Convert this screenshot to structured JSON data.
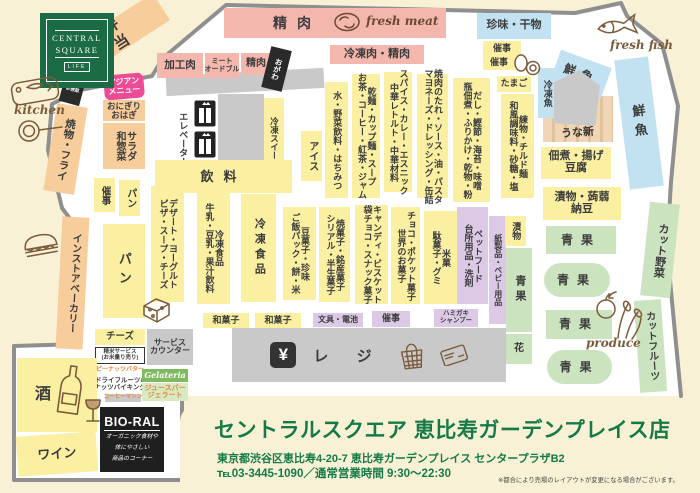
{
  "page": {
    "background": "#F8F1D6",
    "floor": "#FFFFFF",
    "boundary": "#8F8F8F"
  },
  "palette": {
    "deli": "#F6CD9B",
    "meat": "#F4B7AE",
    "fish": "#C2E2F1",
    "groc": "#FBF0A1",
    "nonf": "#DCC9E6",
    "prod": "#CBE3BF",
    "gray": "#C9C9C9",
    "black": "#2A2A2A",
    "pink": "#EC4B95",
    "plain": "transparent",
    "wchip": "#FFFFFF",
    "gchip": "#7FB960",
    "gchip2": "#D8EAC2",
    "accent_green": "#157A47",
    "hand_brown": "#7B5B3A"
  },
  "logo": {
    "line1": "CENTRAL",
    "line2": "SQUARE",
    "line3": "LIFE"
  },
  "annotations": {
    "kitchen": "kitchen",
    "fresh_meat": "fresh meat",
    "fresh_fish": "fresh fish",
    "produce": "produce",
    "unagi_counter": "うな新"
  },
  "checkout": {
    "yen_symbol": "¥",
    "register_label": "レ ジ"
  },
  "bioral": {
    "name": "BIO-RAL",
    "desc_line1": "オーガニック食材や",
    "desc_line2": "体にやさしい",
    "desc_line3": "商品のコーナー"
  },
  "footer": {
    "store_name": "セントラルスクエア 恵比寿ガーデンプレイス店",
    "address": "東京都渋谷区恵比寿4-20-7 恵比寿ガーデンプレイス センタープラザB2",
    "tel_hours": "℡03-3445-1090／通常営業時間 9:30～22:30",
    "note": "※都合により売場のレイアウトが変更になる場合がございます。"
  },
  "areas": [
    {
      "n": "counter-top-gray",
      "t": "gray",
      "x": 166,
      "y": 72,
      "w": 158,
      "h": 20,
      "r": -3,
      "d": "h",
      "fs": 9,
      "lines": []
    },
    {
      "n": "elevator-shaft",
      "t": "gray",
      "x": 218,
      "y": 94,
      "w": 46,
      "h": 68,
      "d": "h",
      "fs": 9,
      "lines": []
    },
    {
      "n": "bento",
      "t": "deli",
      "x": 62,
      "y": 20,
      "w": 108,
      "h": 32,
      "r": -33,
      "d": "v",
      "fs": 15,
      "ls": 4,
      "lines": [
        "弁当"
      ]
    },
    {
      "n": "meat-band",
      "t": "meat",
      "x": 224,
      "y": 8,
      "w": 222,
      "h": 30,
      "d": "h",
      "fs": 10,
      "lines": []
    },
    {
      "n": "meat-band-label",
      "t": "plain",
      "x": 258,
      "y": 12,
      "w": 78,
      "h": 22,
      "d": "h",
      "fs": 14,
      "ls": 10,
      "lines": [
        "精肉"
      ]
    },
    {
      "n": "processed-meat",
      "t": "meat",
      "x": 157,
      "y": 53,
      "w": 46,
      "h": 25,
      "d": "h",
      "fs": 10.5,
      "lines": [
        "加工肉"
      ]
    },
    {
      "n": "meat-hors-doeuvre",
      "t": "meat",
      "x": 205,
      "y": 53,
      "w": 34,
      "h": 25,
      "d": "h",
      "fs": 7,
      "lines": [
        "ミート",
        "オードブル"
      ]
    },
    {
      "n": "fresh-meat-small",
      "t": "meat",
      "x": 241,
      "y": 53,
      "w": 30,
      "h": 22,
      "d": "h",
      "fs": 10,
      "lines": [
        "精肉"
      ]
    },
    {
      "n": "ogawa-shop",
      "t": "black",
      "x": 266,
      "y": 48,
      "w": 21,
      "h": 42,
      "r": 14,
      "d": "v",
      "fs": 7.5,
      "c": "#fff",
      "lines": [
        "おがわ"
      ]
    },
    {
      "n": "frozen-meat",
      "t": "meat",
      "x": 330,
      "y": 45,
      "w": 94,
      "h": 19,
      "d": "h",
      "fs": 11,
      "lines": [
        "冷凍肉・精肉"
      ]
    },
    {
      "n": "delicacies-dried-fish",
      "t": "fish",
      "x": 477,
      "y": 13,
      "w": 74,
      "h": 26,
      "d": "h",
      "fs": 11,
      "lines": [
        "珍味・干物"
      ]
    },
    {
      "n": "event-space-a",
      "t": "groc",
      "x": 483,
      "y": 41,
      "w": 38,
      "h": 15,
      "d": "h",
      "fs": 9,
      "lines": [
        "催事"
      ]
    },
    {
      "n": "event-space-b",
      "t": "groc",
      "x": 483,
      "y": 56,
      "w": 32,
      "h": 14,
      "d": "h",
      "fs": 9,
      "lines": [
        "催事"
      ]
    },
    {
      "n": "eggs-shelf",
      "t": "groc",
      "x": 497,
      "y": 76,
      "w": 34,
      "h": 16,
      "d": "h",
      "fs": 9,
      "lines": [
        "たまご"
      ]
    },
    {
      "n": "frozen-fish",
      "t": "fish",
      "x": 538,
      "y": 68,
      "w": 18,
      "h": 50,
      "d": "v",
      "fs": 9,
      "lines": [
        "冷凍魚"
      ]
    },
    {
      "n": "fresh-fish-corner",
      "t": "fish",
      "x": 554,
      "y": 58,
      "w": 54,
      "h": 32,
      "r": 20,
      "d": "h",
      "fs": 12,
      "ls": 6,
      "lines": [
        "鮮魚"
      ]
    },
    {
      "n": "fish-counter",
      "t": "gray",
      "cls": "pent",
      "x": 554,
      "y": 70,
      "w": 46,
      "h": 56,
      "d": "h",
      "fs": 9,
      "lines": []
    },
    {
      "n": "fresh-fish-band",
      "t": "fish",
      "x": 622,
      "y": 58,
      "w": 34,
      "h": 130,
      "r": -7,
      "d": "v",
      "fs": 13,
      "ls": 6,
      "lines": [
        "鮮魚"
      ]
    },
    {
      "n": "tsukudani-fried-tofu",
      "t": "groc",
      "x": 541,
      "y": 147,
      "w": 70,
      "h": 32,
      "d": "h",
      "fs": 11,
      "lines": [
        "佃煮・揚げ",
        "豆腐"
      ]
    },
    {
      "n": "pickles-konnyaku-natto",
      "t": "groc",
      "x": 543,
      "y": 187,
      "w": 78,
      "h": 33,
      "d": "h",
      "fs": 11,
      "lines": [
        "漬物・蒟蒻",
        "納豆"
      ]
    },
    {
      "n": "produce-1",
      "t": "prod",
      "x": 546,
      "y": 226,
      "w": 70,
      "h": 28,
      "d": "h",
      "fs": 12,
      "ls": 8,
      "lines": [
        "青果"
      ]
    },
    {
      "n": "produce-2",
      "t": "prod",
      "x": 544,
      "y": 263,
      "w": 66,
      "h": 34,
      "br": 17,
      "d": "h",
      "fs": 12,
      "ls": 8,
      "lines": [
        "青果"
      ]
    },
    {
      "n": "produce-3",
      "t": "prod",
      "x": 546,
      "y": 310,
      "w": 66,
      "h": 29,
      "d": "h",
      "fs": 12,
      "ls": 8,
      "lines": [
        "青果"
      ]
    },
    {
      "n": "produce-4",
      "t": "prod",
      "x": 547,
      "y": 350,
      "w": 65,
      "h": 34,
      "br": 17,
      "d": "h",
      "fs": 12,
      "ls": 8,
      "lines": [
        "青果"
      ]
    },
    {
      "n": "produce-strip",
      "t": "prod",
      "x": 506,
      "y": 248,
      "w": 26,
      "h": 84,
      "d": "v",
      "fs": 11,
      "ls": 4,
      "lines": [
        "青果"
      ]
    },
    {
      "n": "flowers",
      "t": "prod",
      "x": 506,
      "y": 334,
      "w": 26,
      "h": 30,
      "d": "h",
      "fs": 10,
      "lines": [
        "花"
      ]
    },
    {
      "n": "cut-vegetables",
      "t": "prod",
      "x": 645,
      "y": 203,
      "w": 30,
      "h": 94,
      "r": 6,
      "d": "v",
      "fs": 11,
      "lines": [
        "カット野菜"
      ]
    },
    {
      "n": "cut-fruits",
      "t": "prod",
      "x": 637,
      "y": 300,
      "w": 27,
      "h": 92,
      "r": -4,
      "d": "v",
      "fs": 10,
      "lines": [
        "カットフルーツ"
      ]
    },
    {
      "n": "bioral-deli-box",
      "t": "black",
      "x": 63,
      "y": 68,
      "w": 21,
      "h": 36,
      "r": 15,
      "d": "h",
      "fs": 4.5,
      "c": "#fff",
      "lines": [
        "BIO-RAL",
        "弁当",
        "お惣菜"
      ]
    },
    {
      "n": "asian-menu",
      "t": "pink",
      "x": 104,
      "y": 74,
      "w": 40,
      "h": 25,
      "r": -5,
      "br": 6,
      "d": "h",
      "fs": 8,
      "c": "#fff",
      "lines": [
        "アジアン",
        "メニュー"
      ]
    },
    {
      "n": "onigiri-ohagi",
      "t": "deli",
      "x": 103,
      "y": 100,
      "w": 42,
      "h": 21,
      "d": "h",
      "fs": 8.5,
      "lines": [
        "おにぎり",
        "おはぎ"
      ]
    },
    {
      "n": "salad-side-dishes",
      "t": "deli",
      "x": 103,
      "y": 123,
      "w": 42,
      "h": 46,
      "d": "v",
      "fs": 10,
      "lines": [
        "サラダ",
        "和惣菜"
      ]
    },
    {
      "n": "grill-fry",
      "t": "deli",
      "x": 50,
      "y": 105,
      "w": 31,
      "h": 88,
      "r": 9,
      "d": "v",
      "fs": 10.5,
      "lines": [
        "焼物・フライ"
      ]
    },
    {
      "n": "instore-bakery",
      "t": "deli",
      "x": 59,
      "y": 217,
      "w": 27,
      "h": 132,
      "r": 3,
      "d": "v",
      "fs": 10,
      "lines": [
        "インストアベーカリー"
      ]
    },
    {
      "n": "event-space-left",
      "t": "groc",
      "x": 94,
      "y": 178,
      "w": 21,
      "h": 34,
      "d": "v",
      "fs": 9.5,
      "lines": [
        "催事"
      ]
    },
    {
      "n": "bread-small",
      "t": "groc",
      "x": 119,
      "y": 180,
      "w": 21,
      "h": 36,
      "d": "v",
      "fs": 10,
      "lines": [
        "パン"
      ]
    },
    {
      "n": "bread-large",
      "t": "groc",
      "x": 103,
      "y": 224,
      "w": 42,
      "h": 94,
      "d": "v",
      "fs": 13,
      "ls": 6,
      "lines": [
        "パン"
      ]
    },
    {
      "n": "elevator-label",
      "t": "plain",
      "x": 174,
      "y": 98,
      "w": 17,
      "h": 82,
      "d": "v",
      "fs": 9,
      "lines": [
        "エレベーター"
      ]
    },
    {
      "n": "frozen-sweets",
      "t": "groc",
      "x": 264,
      "y": 98,
      "w": 20,
      "h": 88,
      "d": "v",
      "fs": 8.5,
      "lines": [
        "冷凍スイーツ"
      ]
    },
    {
      "n": "ice-cream",
      "t": "groc",
      "x": 301,
      "y": 131,
      "w": 21,
      "h": 50,
      "d": "v",
      "fs": 10,
      "lines": [
        "アイス"
      ]
    },
    {
      "n": "drinks",
      "t": "groc",
      "x": 155,
      "y": 160,
      "w": 137,
      "h": 33,
      "d": "h",
      "fs": 13,
      "ls": 10,
      "lines": [
        "飲料"
      ]
    },
    {
      "n": "water-vegetable-juice-honey",
      "t": "groc",
      "x": 325,
      "y": 82,
      "w": 23,
      "h": 116,
      "d": "v",
      "fs": 9,
      "lines": [
        "水・野菜飲料・はちみつ"
      ]
    },
    {
      "n": "dried-noodles-tea-coffee",
      "t": "groc",
      "x": 352,
      "y": 74,
      "w": 28,
      "h": 124,
      "d": "v",
      "fs": 9,
      "lines": [
        "乾麺・カップ麺・スープ",
        "お茶・コーヒー・紅茶・ジャム"
      ]
    },
    {
      "n": "spice-curry-ethnic",
      "t": "groc",
      "x": 384,
      "y": 72,
      "w": 28,
      "h": 120,
      "d": "v",
      "fs": 9,
      "lines": [
        "スパイス・カレー・エスニック",
        "中華レトルト・中華材料"
      ]
    },
    {
      "n": "yakiniku-sauce-oil-pasta",
      "t": "groc",
      "x": 417,
      "y": 74,
      "w": 31,
      "h": 124,
      "d": "v",
      "fs": 9,
      "lines": [
        "焼肉のたれ・ソース・油・パスタ",
        "マヨネーズ・ドレッシング・缶詰"
      ]
    },
    {
      "n": "dashi-seaweed-miso",
      "t": "groc",
      "x": 453,
      "y": 78,
      "w": 37,
      "h": 124,
      "d": "v",
      "fs": 9,
      "lines": [
        "だし・鰹節・海苔・味噌",
        "瓶佃煮・ふりかけ・乾物・粉"
      ]
    },
    {
      "n": "fishcake-chilled-noodles",
      "t": "groc",
      "x": 501,
      "y": 94,
      "w": 33,
      "h": 104,
      "d": "v",
      "fs": 9,
      "lines": [
        "練物・チルド麺",
        "和風調味料・砂糖・塩"
      ]
    },
    {
      "n": "dessert-yogurt-pizza",
      "t": "groc",
      "x": 151,
      "y": 186,
      "w": 33,
      "h": 116,
      "d": "v",
      "fs": 9,
      "lines": [
        "デザート・ヨーグルト",
        "ピザ・スープ・チーズ"
      ]
    },
    {
      "n": "milk-soymilk-juice",
      "t": "groc",
      "x": 197,
      "y": 192,
      "w": 33,
      "h": 112,
      "d": "v",
      "fs": 9,
      "lines": [
        "冷凍食品",
        "牛乳・豆乳・果汁飲料"
      ]
    },
    {
      "n": "frozen-foods",
      "t": "groc",
      "x": 241,
      "y": 194,
      "w": 35,
      "h": 108,
      "d": "v",
      "fs": 11,
      "ls": 4,
      "lines": [
        "冷凍食品"
      ]
    },
    {
      "n": "bean-snacks-rice-pack",
      "t": "groc",
      "x": 283,
      "y": 207,
      "w": 33,
      "h": 93,
      "d": "v",
      "fs": 9,
      "lines": [
        "豆菓子・珍味",
        "ご飯パック・餅・米"
      ]
    },
    {
      "n": "baked-sweets-cereal",
      "t": "groc",
      "x": 319,
      "y": 207,
      "w": 31,
      "h": 95,
      "d": "v",
      "fs": 9,
      "lines": [
        "焼菓子・銘産菓子",
        "シリアル・半生菓子"
      ]
    },
    {
      "n": "candy-biscuits",
      "t": "groc",
      "x": 355,
      "y": 205,
      "w": 33,
      "h": 99,
      "d": "v",
      "fs": 9,
      "lines": [
        "キャンディ・ビスケット",
        "袋チョコ・スナック菓子"
      ]
    },
    {
      "n": "chocolate-world-snacks",
      "t": "groc",
      "x": 391,
      "y": 207,
      "w": 29,
      "h": 97,
      "d": "v",
      "fs": 9,
      "lines": [
        "チョコ・ポケット菓子",
        "世界のお菓子"
      ]
    },
    {
      "n": "rice-crackers-gummies",
      "t": "groc",
      "x": 424,
      "y": 211,
      "w": 33,
      "h": 93,
      "d": "v",
      "fs": 9,
      "lines": [
        "米菓",
        "駄菓子・グミ"
      ]
    },
    {
      "n": "petfood-kitchen-detergent",
      "t": "nonf",
      "x": 457,
      "y": 207,
      "w": 31,
      "h": 97,
      "d": "v",
      "fs": 9,
      "lines": [
        "ペットフード",
        "台所用品・洗剤"
      ]
    },
    {
      "n": "paper-baby-products",
      "t": "nonf",
      "x": 489,
      "y": 216,
      "w": 17,
      "h": 108,
      "d": "v",
      "fs": 8,
      "lines": [
        "紙製品・ベビー用品"
      ]
    },
    {
      "n": "pickles-small",
      "t": "groc",
      "x": 505,
      "y": 216,
      "w": 21,
      "h": 30,
      "d": "v",
      "fs": 9,
      "lines": [
        "漬物"
      ]
    },
    {
      "n": "wagashi-a",
      "t": "groc",
      "x": 203,
      "y": 313,
      "w": 46,
      "h": 15,
      "d": "h",
      "fs": 9,
      "lines": [
        "和菓子"
      ]
    },
    {
      "n": "wagashi-b",
      "t": "groc",
      "x": 255,
      "y": 313,
      "w": 46,
      "h": 15,
      "d": "h",
      "fs": 9,
      "lines": [
        "和菓子"
      ]
    },
    {
      "n": "stationery-batteries",
      "t": "nonf",
      "x": 313,
      "y": 313,
      "w": 50,
      "h": 14,
      "d": "h",
      "fs": 8,
      "lines": [
        "文具・電池"
      ]
    },
    {
      "n": "event-space-c",
      "t": "nonf",
      "x": 372,
      "y": 311,
      "w": 38,
      "h": 16,
      "d": "h",
      "fs": 9,
      "lines": [
        "催事"
      ]
    },
    {
      "n": "toothpaste-shampoo",
      "t": "nonf",
      "x": 434,
      "y": 309,
      "w": 44,
      "h": 18,
      "d": "h",
      "fs": 6.5,
      "lines": [
        "ハミガキ",
        "シャンプー"
      ]
    },
    {
      "n": "cheese-corner",
      "t": "groc",
      "x": 95,
      "y": 329,
      "w": 50,
      "h": 16,
      "d": "h",
      "fs": 9.5,
      "lines": [
        "チーズ"
      ]
    },
    {
      "n": "service-counter",
      "t": "gray",
      "x": 147,
      "y": 329,
      "w": 46,
      "h": 36,
      "d": "h",
      "fs": 8,
      "lines": [
        "サービス",
        "カウンター"
      ]
    },
    {
      "n": "rice-milling-service",
      "t": "wchip",
      "cls": "bordered",
      "x": 95,
      "y": 347,
      "w": 50,
      "h": 17,
      "d": "h",
      "fs": 5.5,
      "lines": [
        "精米サービス",
        "(お米量り売り)"
      ]
    },
    {
      "n": "peanut-butter",
      "t": "wchip",
      "x": 97,
      "y": 366,
      "w": 46,
      "h": 9,
      "d": "h",
      "fs": 6,
      "c": "#E8833A",
      "lines": [
        "ピーナッツバター"
      ]
    },
    {
      "n": "dried-fruits-nuts",
      "t": "wchip",
      "x": 95,
      "y": 376,
      "w": 50,
      "h": 17,
      "d": "h",
      "fs": 6.5,
      "lines": [
        "ドライフルーツ&",
        "ナッツバイキング"
      ]
    },
    {
      "n": "coffee-machine",
      "t": "gray",
      "x": 105,
      "y": 394,
      "w": 36,
      "h": 8,
      "d": "h",
      "fs": 5.5,
      "c": "#E8833A",
      "lines": [
        "コーヒーマシン"
      ]
    },
    {
      "n": "gelateria",
      "t": "gchip",
      "cls": "ital",
      "x": 142,
      "y": 369,
      "w": 46,
      "h": 13,
      "d": "h",
      "fs": 8,
      "c": "#fff",
      "lines": [
        "Gelateria"
      ]
    },
    {
      "n": "juice-bar-gelato",
      "t": "gchip2",
      "x": 142,
      "y": 383,
      "w": 46,
      "h": 18,
      "d": "h",
      "fs": 7,
      "c": "#E8833A",
      "lines": [
        "ジュースバー",
        "ジェラート"
      ]
    },
    {
      "n": "sake",
      "t": "groc",
      "cls": "sake",
      "x": 17,
      "y": 358,
      "w": 80,
      "h": 74,
      "d": "h",
      "fs": 16,
      "lines": [
        "酒"
      ]
    },
    {
      "n": "wine",
      "t": "groc",
      "x": 17,
      "y": 434,
      "w": 80,
      "h": 40,
      "r": -4,
      "d": "h",
      "fs": 13,
      "lines": [
        "ワイン"
      ]
    }
  ]
}
